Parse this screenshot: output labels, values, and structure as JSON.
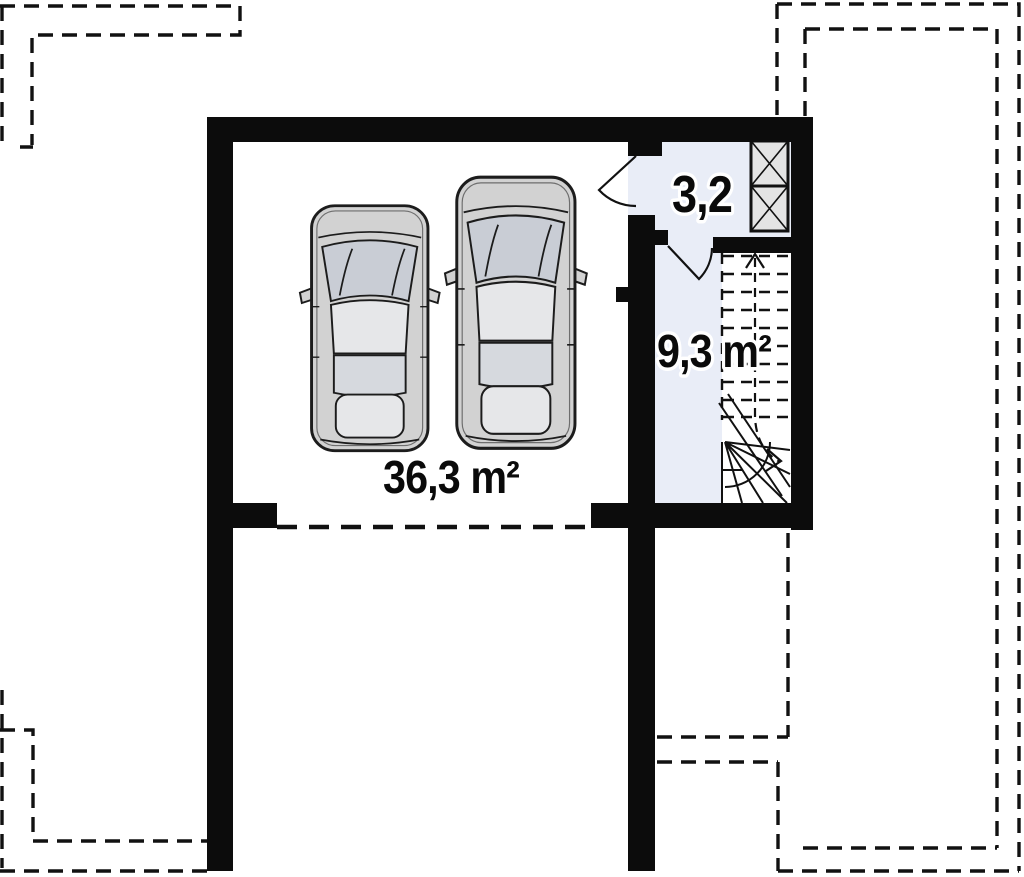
{
  "plan": {
    "type": "floor-plan-garage-level",
    "rooms": {
      "garage": {
        "area_label": "36,3 m²"
      },
      "entry": {
        "area_label": "3,2"
      },
      "stair_hall": {
        "area_label": "9,3 m²"
      }
    },
    "features": [
      "two-cars-top-view",
      "chimney-flues-crossed",
      "winder-staircase-up",
      "garage-door-dashed-opening",
      "roof-and-upper-floor-dashed-outlines",
      "swing-door-to-entry",
      "swing-door-to-stair-hall"
    ],
    "colors": {
      "background": "#ffffff",
      "wall": "#0c0c0c",
      "line": "#111111",
      "room_floor_tint": "#e9edf7",
      "chimney_fill": "#e4e4e4",
      "car_body": "#d2d2d2",
      "car_glass": "#c9cdd5",
      "car_panel": "#e6e7e9",
      "car_cabin": "#d6d9de"
    }
  }
}
